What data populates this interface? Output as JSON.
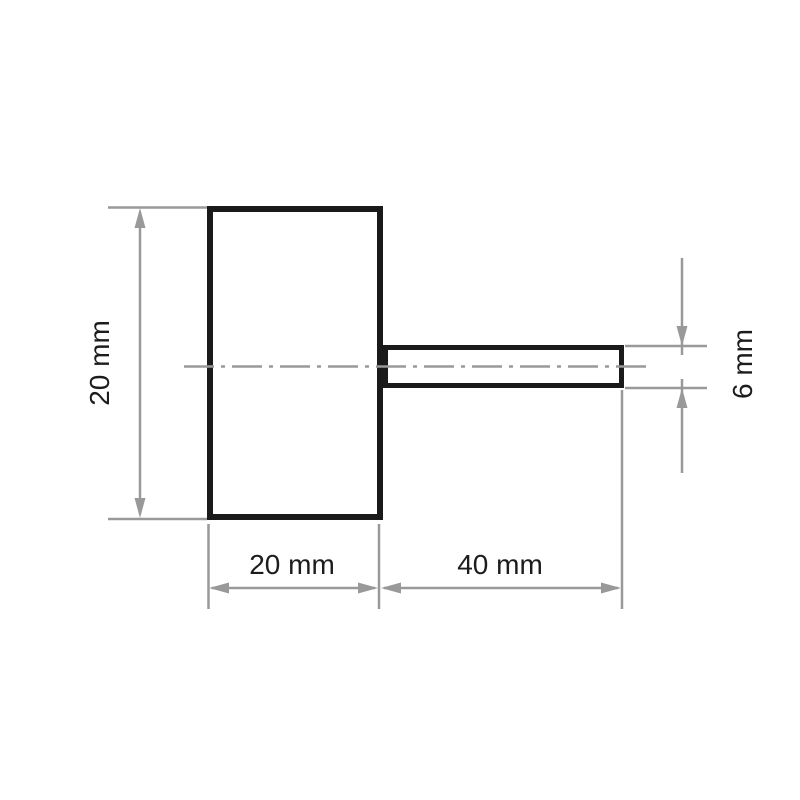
{
  "drawing": {
    "dimensions": {
      "body_height": "20 mm",
      "body_width": "20 mm",
      "shank_length": "40 mm",
      "shank_diameter": "6 mm"
    },
    "colors": {
      "outline": "#1a1a1a",
      "dim_lines": "#999999",
      "label_text": "#1c1c1c",
      "background": "#ffffff"
    }
  }
}
